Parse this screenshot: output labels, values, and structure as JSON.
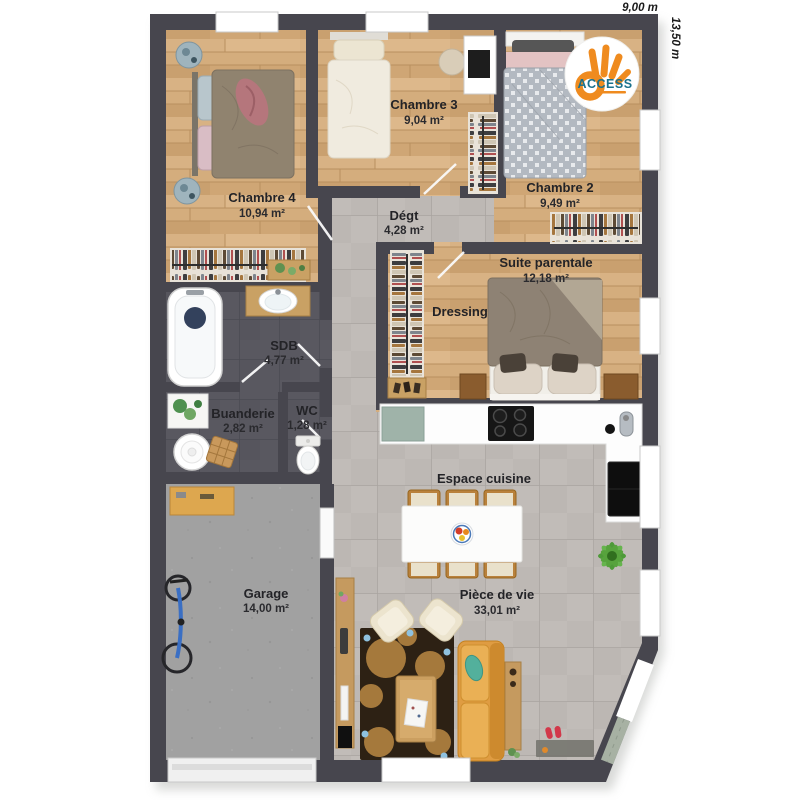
{
  "dimensions": {
    "width_label": "9,00 m",
    "height_label": "13,50 m"
  },
  "logo": {
    "brand": "ACCESS"
  },
  "rooms": {
    "chambre4": {
      "label": "Chambre 4",
      "area": "10,94 m²"
    },
    "chambre3": {
      "label": "Chambre 3",
      "area": "9,04 m²"
    },
    "chambre2": {
      "label": "Chambre 2",
      "area": "9,49 m²"
    },
    "degt": {
      "label": "Dégt",
      "area": "4,28 m²"
    },
    "suite": {
      "label": "Suite parentale",
      "area": "12,18 m²"
    },
    "dressing": {
      "label": "Dressing"
    },
    "sdb": {
      "label": "SDB",
      "area": "4,77 m²"
    },
    "buanderie": {
      "label": "Buanderie",
      "area": "2,82 m²"
    },
    "wc": {
      "label": "WC",
      "area": "1,28 m²"
    },
    "cuisine": {
      "label": "Espace cuisine"
    },
    "piece_de_vie": {
      "label": "Pièce de vie",
      "area": "33,01 m²"
    },
    "garage": {
      "label": "Garage",
      "area": "14,00 m²"
    }
  },
  "colors": {
    "wall": "#47464e",
    "wood_floor": "#d4ad7d",
    "tile_light": "#bfbab6",
    "tile_dark": "#595860",
    "concrete": "#a1a1a1",
    "logo_orange": "#ef8b1f",
    "logo_blue": "#19718c"
  }
}
